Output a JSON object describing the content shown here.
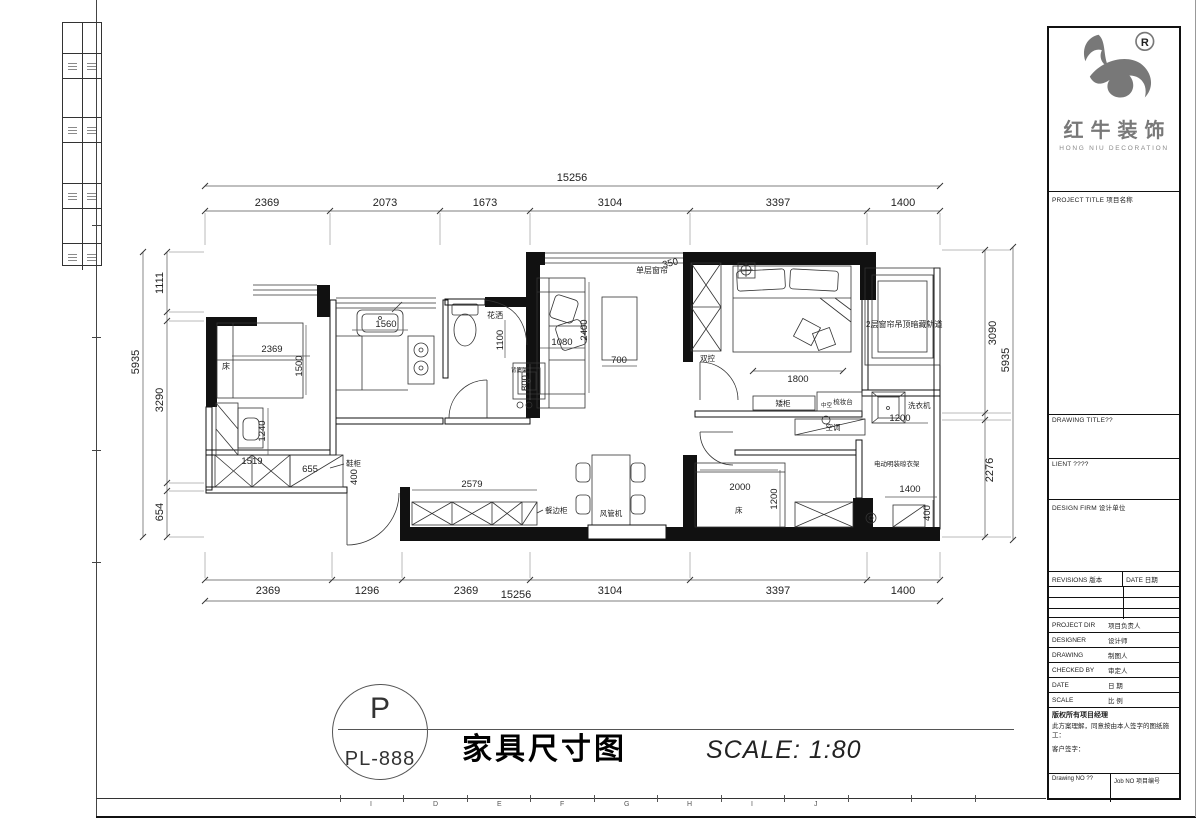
{
  "logo": {
    "registered": "R",
    "brand_cn": "红牛装饰",
    "brand_en": "HONG NIU DECORATION"
  },
  "titlebar": {
    "circle_top": "P",
    "circle_bottom": "PL-888",
    "drawing_title": "家具尺寸图",
    "scale_text": "SCALE: 1:80"
  },
  "ruler_letters": [
    "I",
    "D",
    "E",
    "F",
    "G",
    "H",
    "I",
    "J"
  ],
  "titleblock": {
    "project_title_label": "PROJECT TITLE 项目名称",
    "drawing_title_label": "DRAWING TITLE??",
    "client_label": "LIENT ????",
    "design_firm_label": "DESIGN FIRM 设计单位",
    "revisions_label": "REVISIONS 版本",
    "revisions_date_label": "DATE 日期",
    "rows": [
      {
        "en": "PROJECT DIR",
        "cn": "项目负责人"
      },
      {
        "en": "DESIGNER",
        "cn": "设计师"
      },
      {
        "en": "DRAWING",
        "cn": "制图人"
      },
      {
        "en": "CHECKED BY",
        "cn": "审定人"
      },
      {
        "en": "DATE",
        "cn": "日 期"
      },
      {
        "en": "SCALE",
        "cn": "比 例"
      }
    ],
    "copyright_line1": "版权所有项目经理",
    "copyright_line2": "此方案理解，同意按由本人签字的图纸施工：",
    "client_sign_label": "客户签字：",
    "drawing_no_label": "Drawing NO ??",
    "job_no_label": "Job NO 项目编号"
  },
  "dims": {
    "top": {
      "overall": "15256",
      "segs": [
        "2369",
        "2073",
        "1673",
        "3104",
        "3397",
        "1400"
      ]
    },
    "bottom": {
      "overall": "15256",
      "segs": [
        "2369",
        "1296",
        "2369",
        "3104",
        "3397",
        "1400"
      ]
    },
    "left": {
      "overall": "5935",
      "segs": [
        "1111",
        "3290",
        "654"
      ]
    },
    "right": {
      "overall": "5935",
      "segs": [
        "3090",
        "2276"
      ]
    }
  },
  "plan": {
    "bed1_label": "床",
    "dim_bed1_w": "2369",
    "dim_bed1_d": "1500",
    "dim_desk": "1240",
    "dim_ward1": "1519",
    "dim_shoe_w": "655",
    "shoe_label": "鞋柜",
    "dim_shoe_d": "400",
    "dim_sink": "1560",
    "shower_label": "花洒",
    "dim_shower": "1100",
    "basin_label": "背篓架",
    "dim_basin": "800",
    "curtain_label": "单层窗帘",
    "dim_curtain": "350",
    "dim_sofa_w": "1080",
    "dim_sofa_l": "2400",
    "dim_ctable": "700",
    "switch_label": "双控",
    "dim_bed2": "1800",
    "lowcab_label": "矮柜",
    "dresser_label": "梳妆台",
    "dresser_note": "中空",
    "ac_label": "空调",
    "curtain2_label": "2层窗帘吊顶暗藏轨道",
    "washer_label": "洗衣机",
    "dim_washer": "1200",
    "rack_label": "电动明装晾衣架",
    "dim_rack_w": "1400",
    "dim_rack_d": "400",
    "dim_sidecab": "2579",
    "sidecab_label": "餐边柜",
    "duct_label": "风管机",
    "bed3_label": "床",
    "dim_bed3_w": "2000",
    "dim_bed3_d": "1200"
  }
}
